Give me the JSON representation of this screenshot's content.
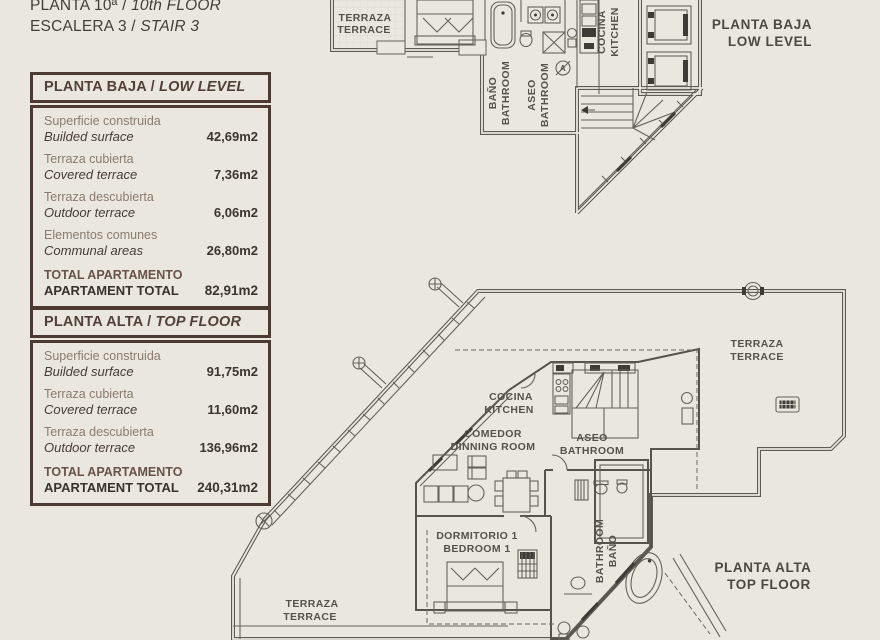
{
  "header": {
    "line1_es": "PLANTA 10ª /",
    "line1_en": "10th FLOOR",
    "line2_es": "ESCALERA 3 /",
    "line2_en": "STAIR 3"
  },
  "tables": [
    {
      "title_es": "PLANTA BAJA /",
      "title_en": "LOW LEVEL",
      "rows": [
        {
          "es": "Superficie construida",
          "en": "Builded surface",
          "value": "42,69m2"
        },
        {
          "es": "Terraza cubierta",
          "en": "Covered terrace",
          "value": "7,36m2"
        },
        {
          "es": "Terraza descubierta",
          "en": "Outdoor terrace",
          "value": "6,06m2"
        },
        {
          "es": "Elementos comunes",
          "en": "Communal areas",
          "value": "26,80m2"
        }
      ],
      "total": {
        "es": "TOTAL APARTAMENTO",
        "en": "APARTAMENT TOTAL",
        "value": "82,91m2"
      }
    },
    {
      "title_es": "PLANTA ALTA /",
      "title_en": "TOP FLOOR",
      "rows": [
        {
          "es": "Superficie construida",
          "en": "Builded surface",
          "value": "91,75m2"
        },
        {
          "es": "Terraza cubierta",
          "en": "Covered terrace",
          "value": "11,60m2"
        },
        {
          "es": "Terraza descubierta",
          "en": "Outdoor terrace",
          "value": "136,96m2"
        }
      ],
      "total": {
        "es": "TOTAL APARTAMENTO",
        "en": "APARTAMENT TOTAL",
        "value": "240,31m2"
      }
    }
  ],
  "plans": {
    "lower": {
      "title_1": "PLANTA BAJA",
      "title_2": "LOW LEVEL",
      "terraza_1": "TERRAZA",
      "terraza_2": "TERRACE",
      "bano_1": "BAÑO",
      "bano_2": "BATHROOM",
      "aseo_1": "ASEO",
      "aseo_2": "BATHROOM",
      "cocina_1": "COCINA",
      "cocina_2": "KITCHEN",
      "marker": "A"
    },
    "upper": {
      "title_1": "PLANTA ALTA",
      "title_2": "TOP FLOOR",
      "terraza_r_1": "TERRAZA",
      "terraza_r_2": "TERRACE",
      "cocina_1": "COCINA",
      "cocina_2": "KITCHEN",
      "comedor_1": "COMEDOR",
      "comedor_2": "DINNING ROOM",
      "aseo_1": "ASEO",
      "aseo_2": "BATHROOM",
      "dorm_1": "DORMITORIO 1",
      "dorm_2": "BEDROOM 1",
      "bano_1": "BAÑO",
      "bano_2": "BATHROOM",
      "terraza_bl_1": "TERRAZA",
      "terraza_bl_2": "TERRACE"
    }
  },
  "colors": {
    "accent": "#4c3a33",
    "plan_line": "#5d5c54",
    "background": "#eae8de"
  }
}
